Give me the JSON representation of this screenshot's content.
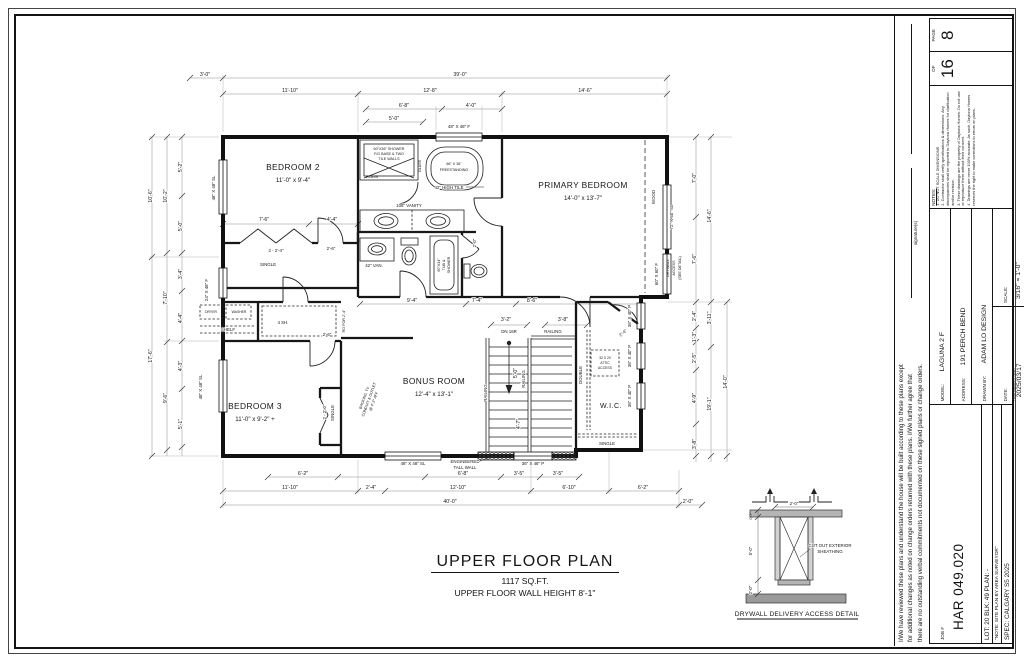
{
  "colors": {
    "paper": "#ffffff",
    "ink": "#161616",
    "dim_line": "#777777"
  },
  "sheet": {
    "title": "UPPER FLOOR PLAN",
    "area": "1117 SQ.FT.",
    "wall_height": "UPPER FLOOR WALL HEIGHT 8'-1\""
  },
  "plan": {
    "rooms": {
      "bedroom2": {
        "name": "BEDROOM 2",
        "size": "11'-0\" x 9'-4\""
      },
      "primary": {
        "name": "PRIMARY BEDROOM",
        "size": "14'-0\" x 13'-7\""
      },
      "bedroom3": {
        "name": "BEDROOM 3",
        "size": "11'-0\" x 9'-2\" +"
      },
      "bonus": {
        "name": "BONUS ROOM",
        "size": "12'-4\" x 13'-1\""
      },
      "wic": {
        "name": "W.I.C."
      }
    },
    "fixtures": {
      "shower_l1": "60\"X36\" SHOWER",
      "shower_l2": "F/G BASE & TWO",
      "shower_l3": "TILE WALLS",
      "glass": "GLASS",
      "tub_l1": "66\" X 36\"",
      "tub_l2": "FREESTANDING",
      "tile_note": "42\" HIGH TILE",
      "vanity_108": "108\" VANITY",
      "vanity_42": "42\" VAN.",
      "tubshower_l1": "60\"X34\"",
      "tubshower_l2": "TUB &",
      "tubshower_l3": "SHOWER",
      "dryer": "DRYER",
      "washer": "WASHER",
      "shelf": "SHELF",
      "shelves4": "4 SH.",
      "attic_l1": "32 X 20",
      "attic_l2": "ATTIC",
      "attic_l3": "ACCESS",
      "double_rod": "DOUBLE",
      "single_rod": "SINGLE",
      "wood": "WOOD"
    },
    "doors": {
      "closet2": "2 - 2'-4\"",
      "bed2_door": "2'-6\"",
      "hall_door": "2'-6\"",
      "closet3": "2 - 2'-0\"",
      "wc_door": "2'-0\"",
      "wic_door": "2'-4\"",
      "laundry_ro": "RO FOR 2'-4\""
    },
    "windows": {
      "bed2": "48\" X 48\" SL",
      "top": "48\" X 48\" F",
      "primary_sl": "72\" X 60\" SL",
      "primary_f": "60\" X 60\" F",
      "wic_p": "36\" X 40\" P",
      "stair_p": "36\" X 48\" P",
      "bonus_sl": "48\" X 48\" SL",
      "bed3_sl": "48\" X 48\" SL",
      "laundry_f": "24\" X 48\" F"
    },
    "stairs": {
      "dn": "DN 16R",
      "railing": "RAILING"
    },
    "notes": {
      "engineered_l1": "ENGINEERED",
      "engineered_l2": "TALL WALL",
      "backing_l1": "BACKING, TV",
      "backing_l2": "CONDUIT & OUTLET",
      "backing_l3": "@ 4'-2\" AFF",
      "drywall_l1": "DRYWALL",
      "drywall_l2": "ACCESS",
      "drywall_l3": "(SEE DETAIL)"
    },
    "dims": {
      "t1a": "3'-0\"",
      "t1b": "39'-0\"",
      "t2a": "11'-10\"",
      "t2b": "12'-8\"",
      "t2c": "14'-6\"",
      "t3a": "6'-8\"",
      "t3b": "4'-0\"",
      "t4a": "5'-0\"",
      "b1a": "6'-2\"",
      "b1b": "6'-8\"",
      "b1c": "3'-5\"",
      "b1d": "3'-5\"",
      "b2a": "11'-10\"",
      "b2b": "2'-4\"",
      "b2c": "12'-10\"",
      "b2d": "6'-10\"",
      "b2e": "6'-2\"",
      "b3a": "40'-0\"",
      "b3b": "2'-0\"",
      "l1a": "10'-6\"",
      "l1b": "17'-6\"",
      "l2a": "10'-2\"",
      "l2b": "7'-10\"",
      "l2c": "9'-6\"",
      "l3a": "5'-2\"",
      "l3b": "5'-0\"",
      "l3c": "3'-4\"",
      "l3d": "4'-4\"",
      "l3e": "4'-3\"",
      "l3f": "5'-1\"",
      "r1a": "7'-0\"",
      "r1b": "7'-6\"",
      "r2a": "14'-6\"",
      "r3a": "2'-4\"",
      "r3b": "1'-3\"",
      "r3c": "2'-5\"",
      "r3d": "4'-9\"",
      "r3e": "3'-8\"",
      "r4a": "3'-11\"",
      "r4b": "19'-1\"",
      "r5a": "14'-0\"",
      "cl_a": "7'-6\"",
      "cl_b": "4'-4\"",
      "hall_a": "9'-4\"",
      "hall_b": "7'-4\"",
      "hall_c": "8'-6\"",
      "st_a": "3'-2\"",
      "st_b": "3'-8\"",
      "st_c": "5'-0\"",
      "st_d": "4'-7\""
    }
  },
  "detail": {
    "title": "DRYWALL DELIVERY ACCESS DETAIL",
    "w": "2'-0\"",
    "h_top": "0'-7\"",
    "h_mid": "5'-0\"",
    "h_bot": "2'-0\"",
    "note_l1": "CUT OUT EXTERIOR",
    "note_l2": "SHEATHING"
  },
  "titleblock": {
    "disclaimer_l1": "I/We have reviewed these plans and understand the house will be built according to these plans except",
    "disclaimer_l2": "for additional changes as noted on change orders returned with these plans. I/We further agree that",
    "disclaimer_l3": "there are no outstanding verbal commitments not documented on these signed plans or change orders.",
    "signature_label": "signature(s)",
    "job_label": "JOB #",
    "job_number": "HAR 049.020",
    "lot_line": "LOT: 20   BLK: 49   PLAN: -",
    "note_line": "\"NOTE: SITE PLAN BY AREA SURVEYOR\"",
    "spec_line": "SPEC: CALGARY S5 2025",
    "model_label": "MODEL:",
    "model": "LAGUNA 2 F",
    "address_label": "ADDRESS:",
    "address": "191 PERCH BEND",
    "drawn_label": "DRAWN BY:",
    "drawn": "ADAM LO DESIGN",
    "date_label": "DATE:",
    "date_caption": "YEAR/MONTH/DAY",
    "date": "2025/03/17",
    "scale_label": "SCALE:",
    "scale": "3/16\" = 1'-0\"",
    "notes_title": "NOTES:",
    "note1": "1. DO NOT SCALE DIMENSIONS",
    "note2": "2. Contractor shall verify specifications & dimensions. Any discrepancies shall be reported to Daytona Homes for clarification and/or revision.",
    "note3": "3. These drawings are the property of Daytona Homes. Do not use or reproduce them without their consent.",
    "note4": "4. Drawings are never 100% accurate. As such, Daytona Homes reserves the right to make corrections to errors on plans.",
    "page_label": "PAGE",
    "page_number": "8",
    "of_label": "OF",
    "page_total": "16"
  }
}
